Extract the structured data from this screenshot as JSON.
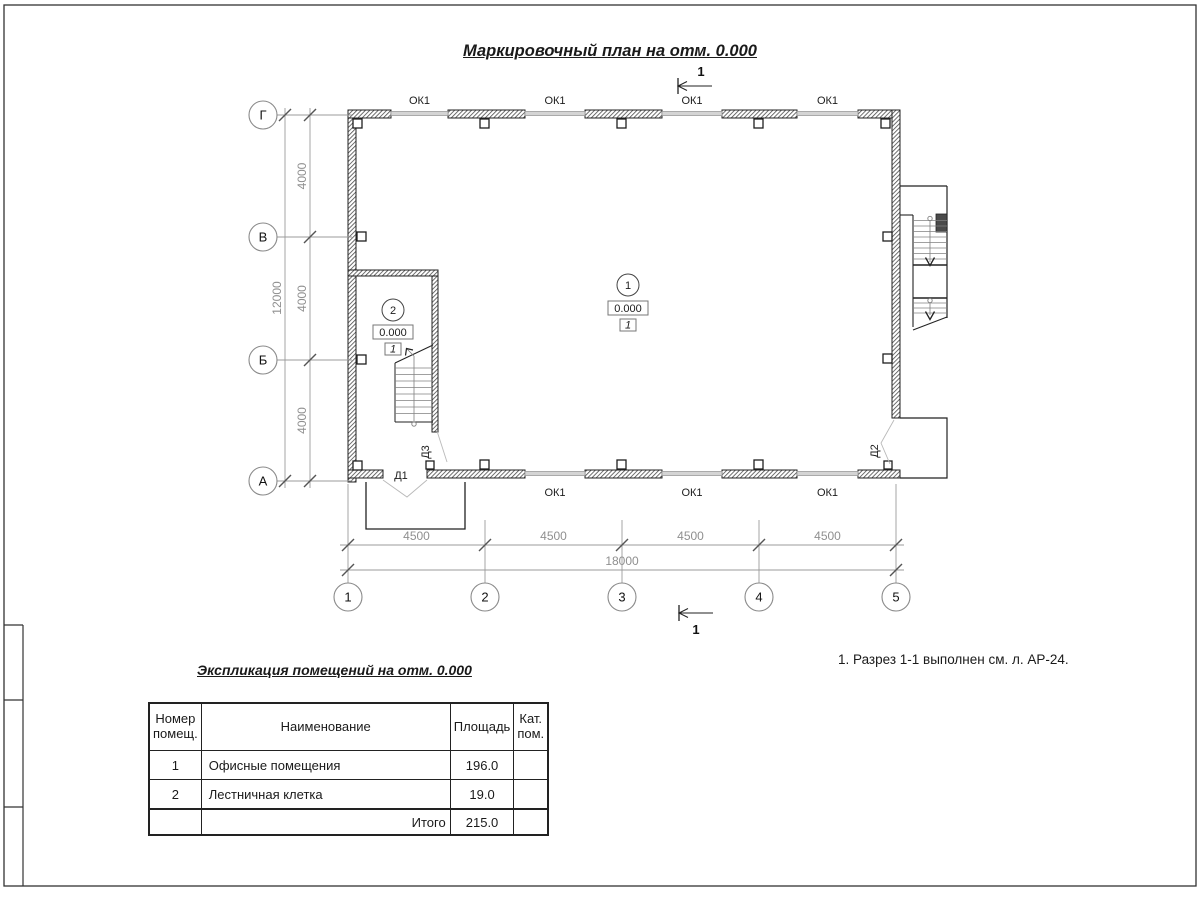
{
  "title": "Маркировочный план на отм. 0.000",
  "note": "1. Разрез 1-1 выполнен см. л. АР-24.",
  "plan": {
    "row_axes": [
      "Г",
      "В",
      "Б",
      "А"
    ],
    "col_axes": [
      "1",
      "2",
      "3",
      "4",
      "5"
    ],
    "dims": {
      "v_segments": [
        "4000",
        "4000",
        "4000"
      ],
      "v_total": "12000",
      "h_segments": [
        "4500",
        "4500",
        "4500",
        "4500"
      ],
      "h_total": "18000"
    },
    "windows_top": [
      "ОК1",
      "ОК1",
      "ОК1",
      "ОК1"
    ],
    "windows_bottom": [
      "ОК1",
      "ОК1",
      "ОК1"
    ],
    "doors": {
      "d1": "Д1",
      "d2": "Д2",
      "d3": "Д3"
    },
    "section_mark": "1",
    "rooms": [
      {
        "number": "1",
        "elevation": "0.000",
        "floor_type": "1"
      },
      {
        "number": "2",
        "elevation": "0.000",
        "floor_type": "1"
      }
    ]
  },
  "explication": {
    "title": "Экспликация помещений на отм. 0.000",
    "headers": {
      "num": "Номер помещ.",
      "name": "Наименование",
      "area": "Площадь",
      "cat": "Кат. пом."
    },
    "rows": [
      {
        "num": "1",
        "name": "Офисные помещения",
        "area": "196.0",
        "cat": ""
      },
      {
        "num": "2",
        "name": "Лестничная клетка",
        "area": "19.0",
        "cat": ""
      }
    ],
    "total_label": "Итого",
    "total_area": "215.0"
  }
}
